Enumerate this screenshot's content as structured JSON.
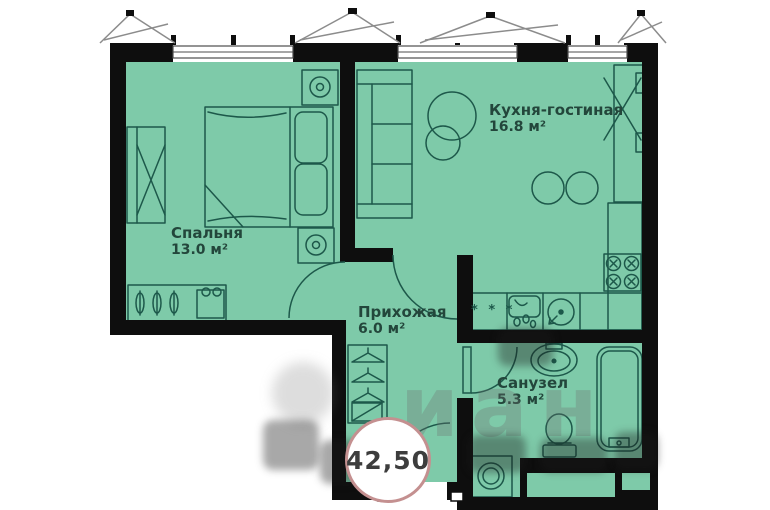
{
  "floorplan": {
    "badge": {
      "total_area": "42,50"
    },
    "rooms": {
      "living_kitchen": {
        "name": "Кухня-гостиная",
        "area": "16.8 м²"
      },
      "bedroom": {
        "name": "Спальня",
        "area": "13.0 м²"
      },
      "hallway": {
        "name": "Прихожая",
        "area": "6.0 м²"
      },
      "bathroom": {
        "name": "Санузел",
        "area": "5.3 м²"
      }
    },
    "markers": {
      "fridge": "* * *"
    },
    "watermark": {
      "text": "иан"
    },
    "colors": {
      "floor": "#7ecaa9",
      "wall": "#0e0e0e",
      "furniture_line": "#1d584a",
      "badge_border": "#c49090",
      "label_text": "#23463b"
    }
  }
}
